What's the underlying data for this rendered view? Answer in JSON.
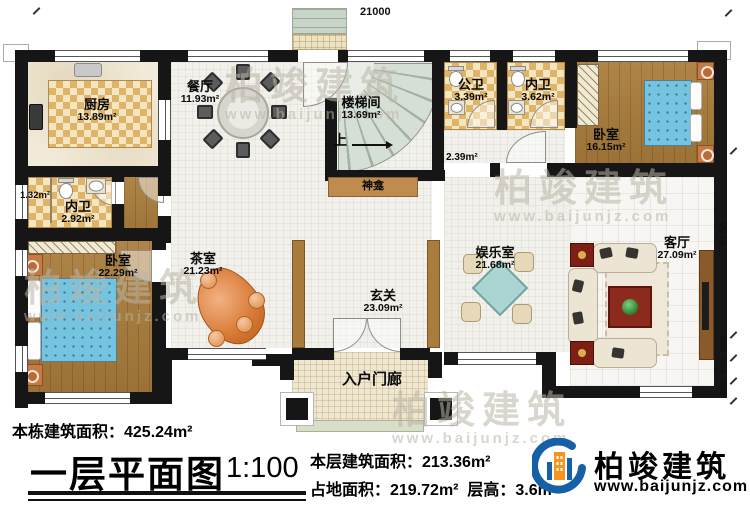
{
  "dimensions": {
    "top": "21000",
    "right": [
      "8700",
      "600",
      "800",
      "400"
    ]
  },
  "rooms": {
    "kitchen": {
      "label": "厨房",
      "area": "13.89m²"
    },
    "dining": {
      "label": "餐厅",
      "area": "11.93m²"
    },
    "stairwell": {
      "label": "楼梯间",
      "area": "13.69m²"
    },
    "stair_up": {
      "label": "上"
    },
    "public_bath": {
      "label": "公卫",
      "area": "3.39m²"
    },
    "ensuite_right": {
      "label": "内卫",
      "area": "3.62m²"
    },
    "bedroom_right": {
      "label": "卧室",
      "area": "16.15m²"
    },
    "corridor": {
      "area": "2.39m²"
    },
    "ensuite_left": {
      "label": "内卫",
      "area": "2.92m²"
    },
    "closet_left": {
      "area": "1.32m²"
    },
    "bedroom_left": {
      "label": "卧室",
      "area": "22.29m²"
    },
    "tea_room": {
      "label": "茶室",
      "area": "21.23m²"
    },
    "foyer": {
      "label": "玄关",
      "area": "23.09m²"
    },
    "entertainment": {
      "label": "娱乐室",
      "area": "21.68m²"
    },
    "living": {
      "label": "客厅",
      "area": "27.09m²"
    },
    "shrine": {
      "label": "神龛"
    },
    "porch": {
      "label": "入户门廊"
    }
  },
  "footer": {
    "building_total": "本栋建筑面积：425.24m²",
    "title": "一层平面图",
    "scale": "1:100",
    "floor_area": "本层建筑面积：213.36m²",
    "footprint": "占地面积：219.72m²",
    "floor_height": "层高：3.6m"
  },
  "brand": {
    "name": "柏竣建筑",
    "url": "www.baijunjz.com"
  },
  "watermark": {
    "name": "柏竣建筑",
    "url": "www.baijunjz.com"
  },
  "colors": {
    "wall": "#161616",
    "wood_floor": "#a87b3b",
    "checker_tile": "#dfb469",
    "bed_blue": "#74c4e0",
    "accent_brown": "#a97c3e",
    "table_red": "#7e1f16",
    "logo_blue": "#1660a8",
    "logo_orange": "#f7941e"
  }
}
